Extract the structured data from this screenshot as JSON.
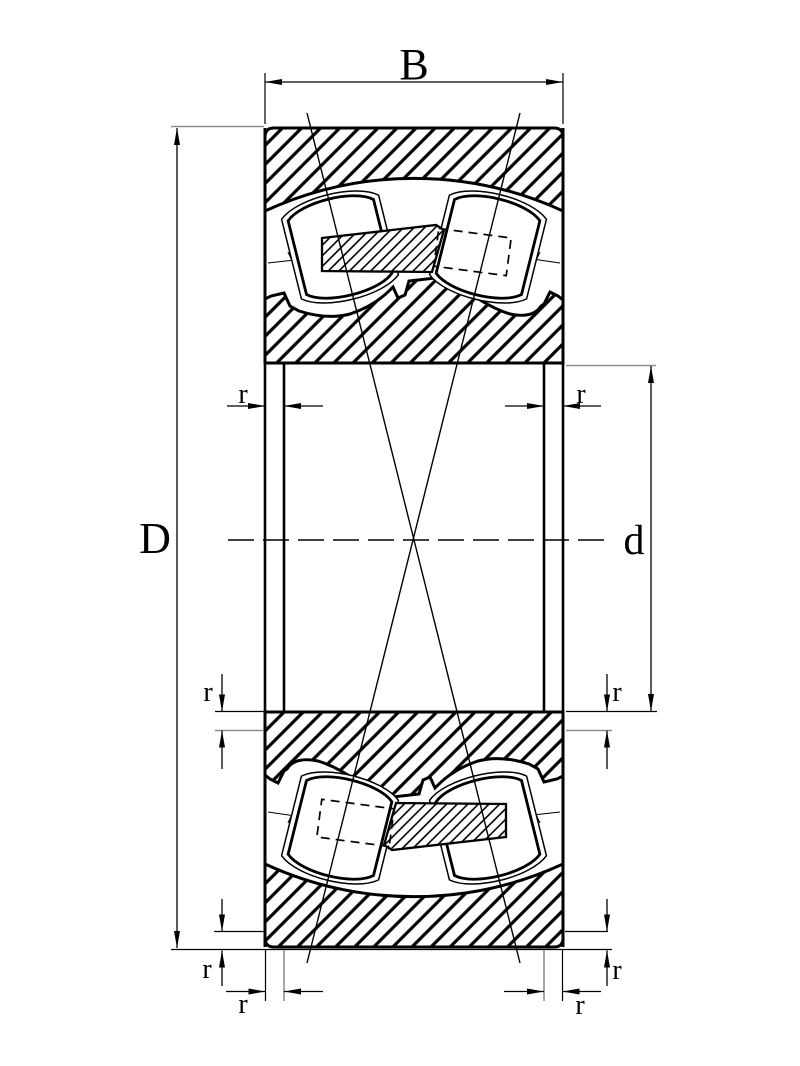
{
  "drawing": {
    "subject": "spherical roller bearing cross-section",
    "labels": {
      "width": "B",
      "outer_diameter": "D",
      "bore_diameter": "d",
      "chamfer": "r"
    },
    "colors": {
      "line": "#000000",
      "extension_gray": "#8f8f8f",
      "background": "#ffffff"
    }
  }
}
